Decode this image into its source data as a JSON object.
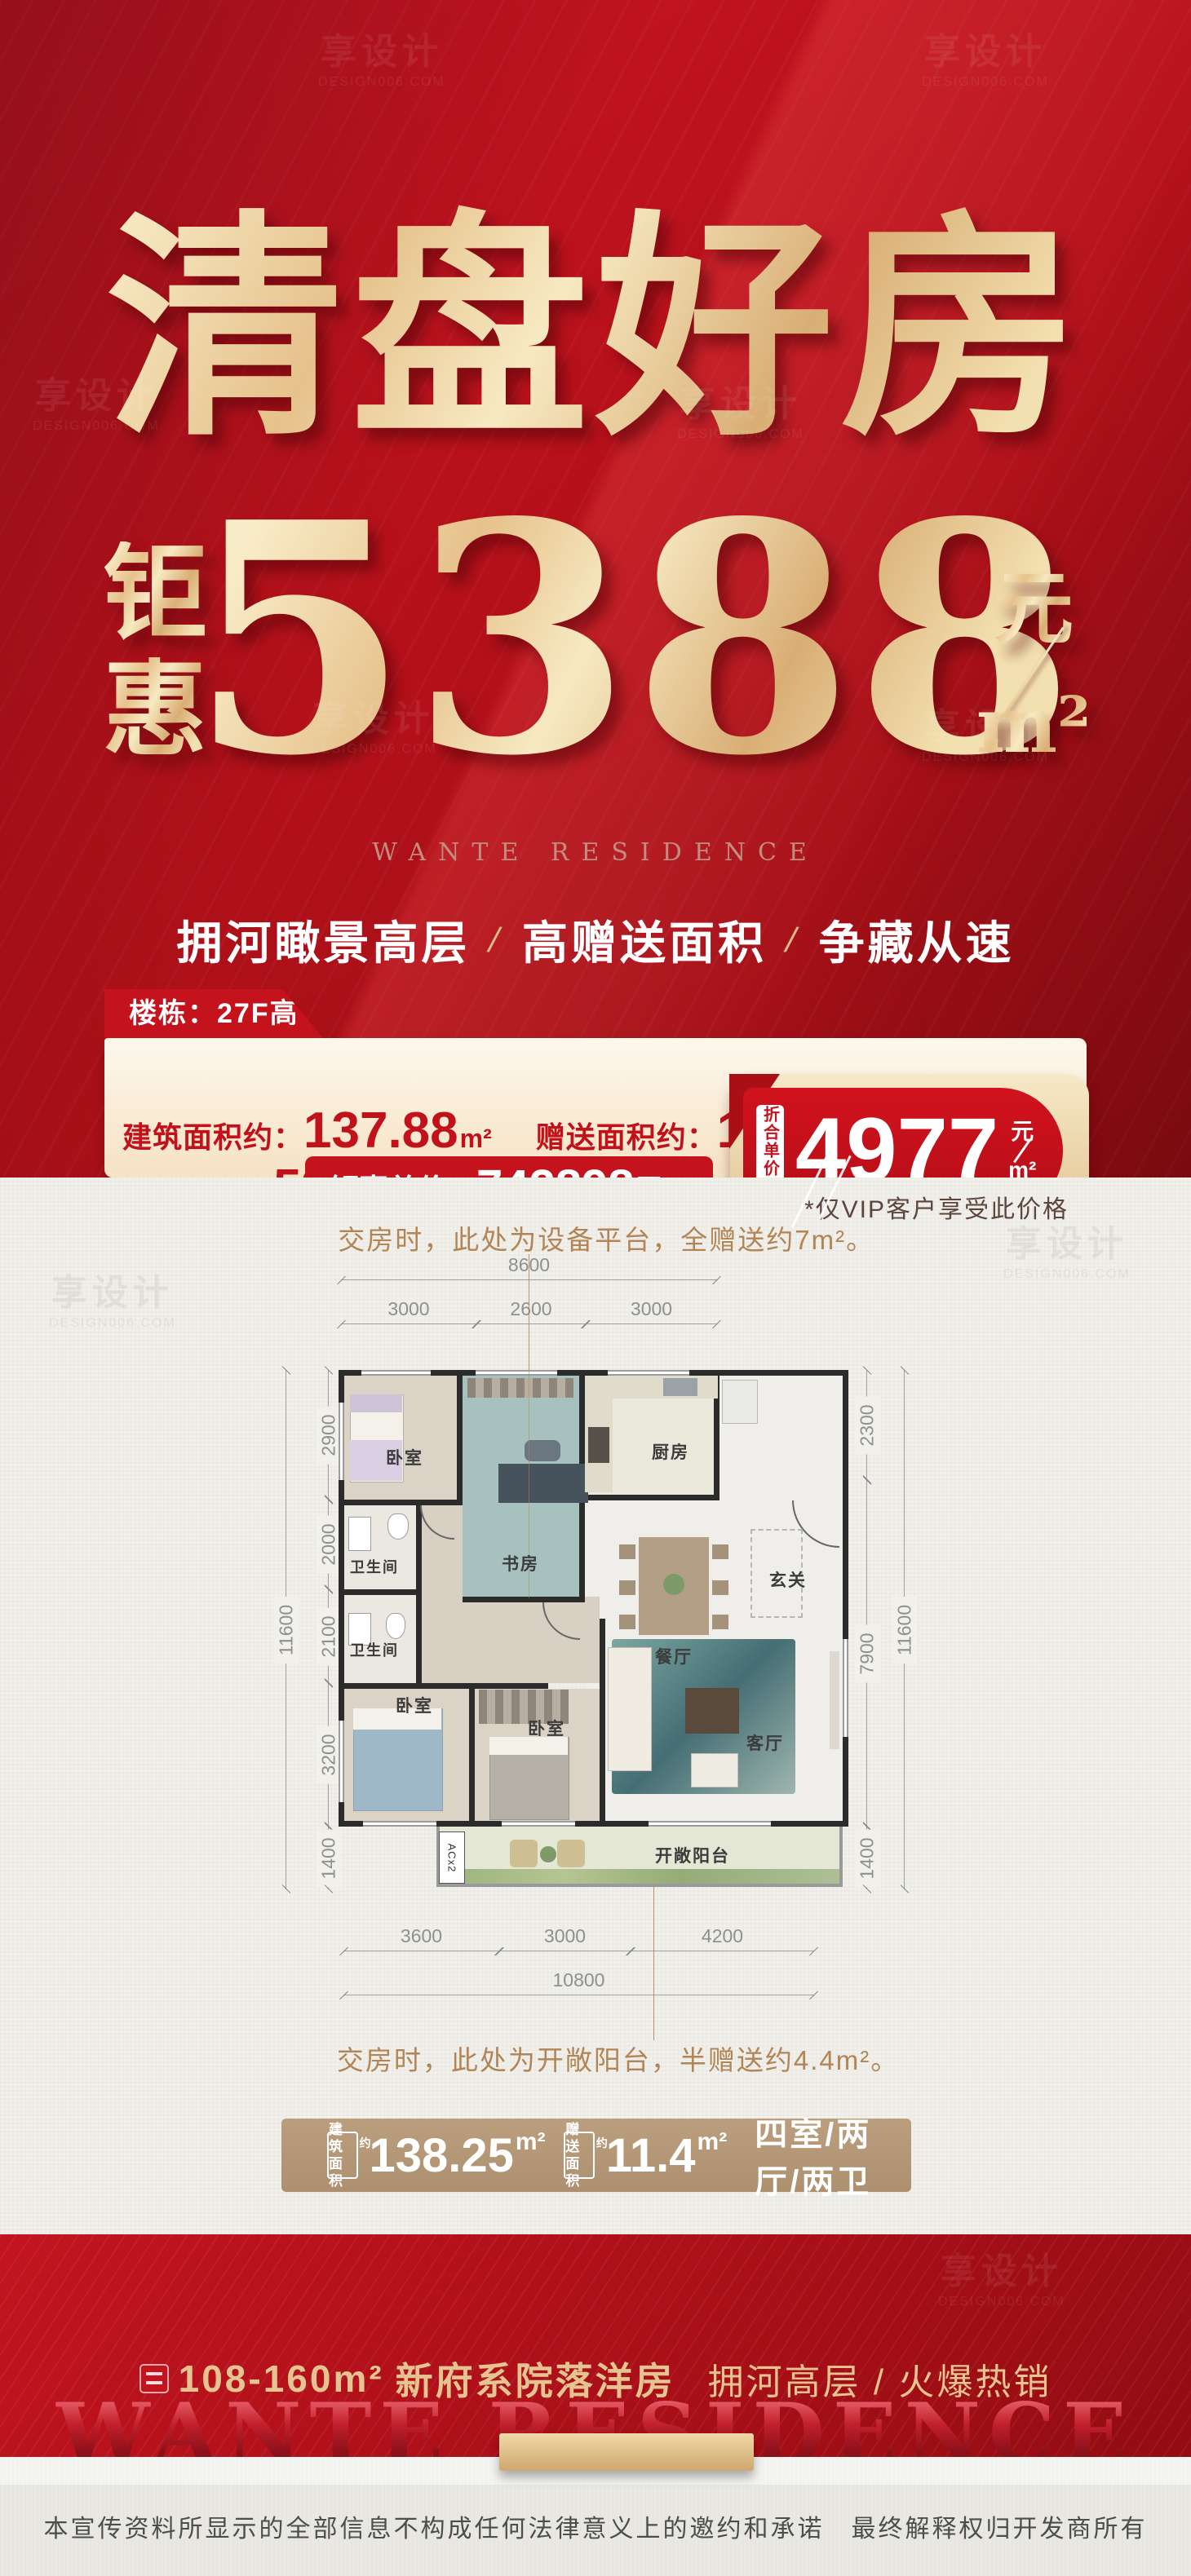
{
  "watermark": {
    "name": "享设计",
    "domain": "DESIGN006.COM"
  },
  "hero": {
    "title": "清盘好房",
    "price_prefix_chars": [
      "钜",
      "惠"
    ],
    "price": "5388",
    "unit_numerator": "元",
    "unit_denominator": "m²",
    "brand": "WANTE RESIDENCE",
    "tagline": [
      "拥河瞰景高层",
      "高赠送面积",
      "争藏从速"
    ],
    "tagline_separator": "/"
  },
  "info": {
    "building_label": "楼栋：",
    "building_value": "27F高层",
    "area_label": "建筑面积约：",
    "area_value": "137.88",
    "area_unit": "m²",
    "gift_label": "赠送面积约：",
    "gift_value": "11.4",
    "gift_unit": "m²",
    "unit_price_label": "钜惠单价：",
    "unit_price_value": "5388",
    "unit_price_unit": "元/m²",
    "total_label": "钜惠总价：",
    "total_value": "742898",
    "total_unit": "元",
    "badge": {
      "prefix": "折合单价约",
      "value": "4977",
      "unit_top": "元",
      "unit_bottom": "m²"
    },
    "vip_note": "*仅VIP客户享受此价格"
  },
  "plan": {
    "note_top": "交房时，此处为设备平台，全赠送约7m²。",
    "note_bottom": "交房时，此处为开敞阳台，半赠送约4.4m²。",
    "ac_label": "ACx2",
    "rooms": {
      "bedroom_a": "卧室",
      "study": "书房",
      "kitchen": "厨房",
      "hall": "玄关",
      "dining": "餐厅",
      "bath_a": "卫生间",
      "bath_b": "卫生间",
      "bedroom_b": "卧室",
      "bedroom_c": "卧室",
      "living": "客厅",
      "balcony": "开敞阳台"
    },
    "dims": {
      "top_overall": "8600",
      "top_segments": [
        "3000",
        "2600",
        "3000"
      ],
      "left_overall": "11600",
      "left_segments": [
        "2900",
        "2000",
        "2100",
        "3200",
        "1400"
      ],
      "right_overall": "11600",
      "right_segments": [
        "2300",
        "7900",
        "1400"
      ],
      "bottom_segments": [
        "3600",
        "3000",
        "4200"
      ],
      "bottom_overall": "10800"
    }
  },
  "area_bar": {
    "chip1_line1": "建筑",
    "chip1_line2": "面积",
    "chip1_suffix": "约",
    "value1": "138.25",
    "unit1": "m²",
    "chip2_line1": "赠送",
    "chip2_line2": "面积",
    "chip2_suffix": "约",
    "value2": "11.4",
    "unit2": "m²",
    "layout": "四室/两厅/两卫"
  },
  "bottom": {
    "range": "108-160m²",
    "series": "新府系院落洋房",
    "sub": "拥河高层 / 火爆热销",
    "brand": "WANTE RESIDENCE"
  },
  "footer": {
    "disclaimer": "本宣传资料所显示的全部信息不构成任何法律意义上的邀约和承诺　最终解释权归开发商所有"
  }
}
